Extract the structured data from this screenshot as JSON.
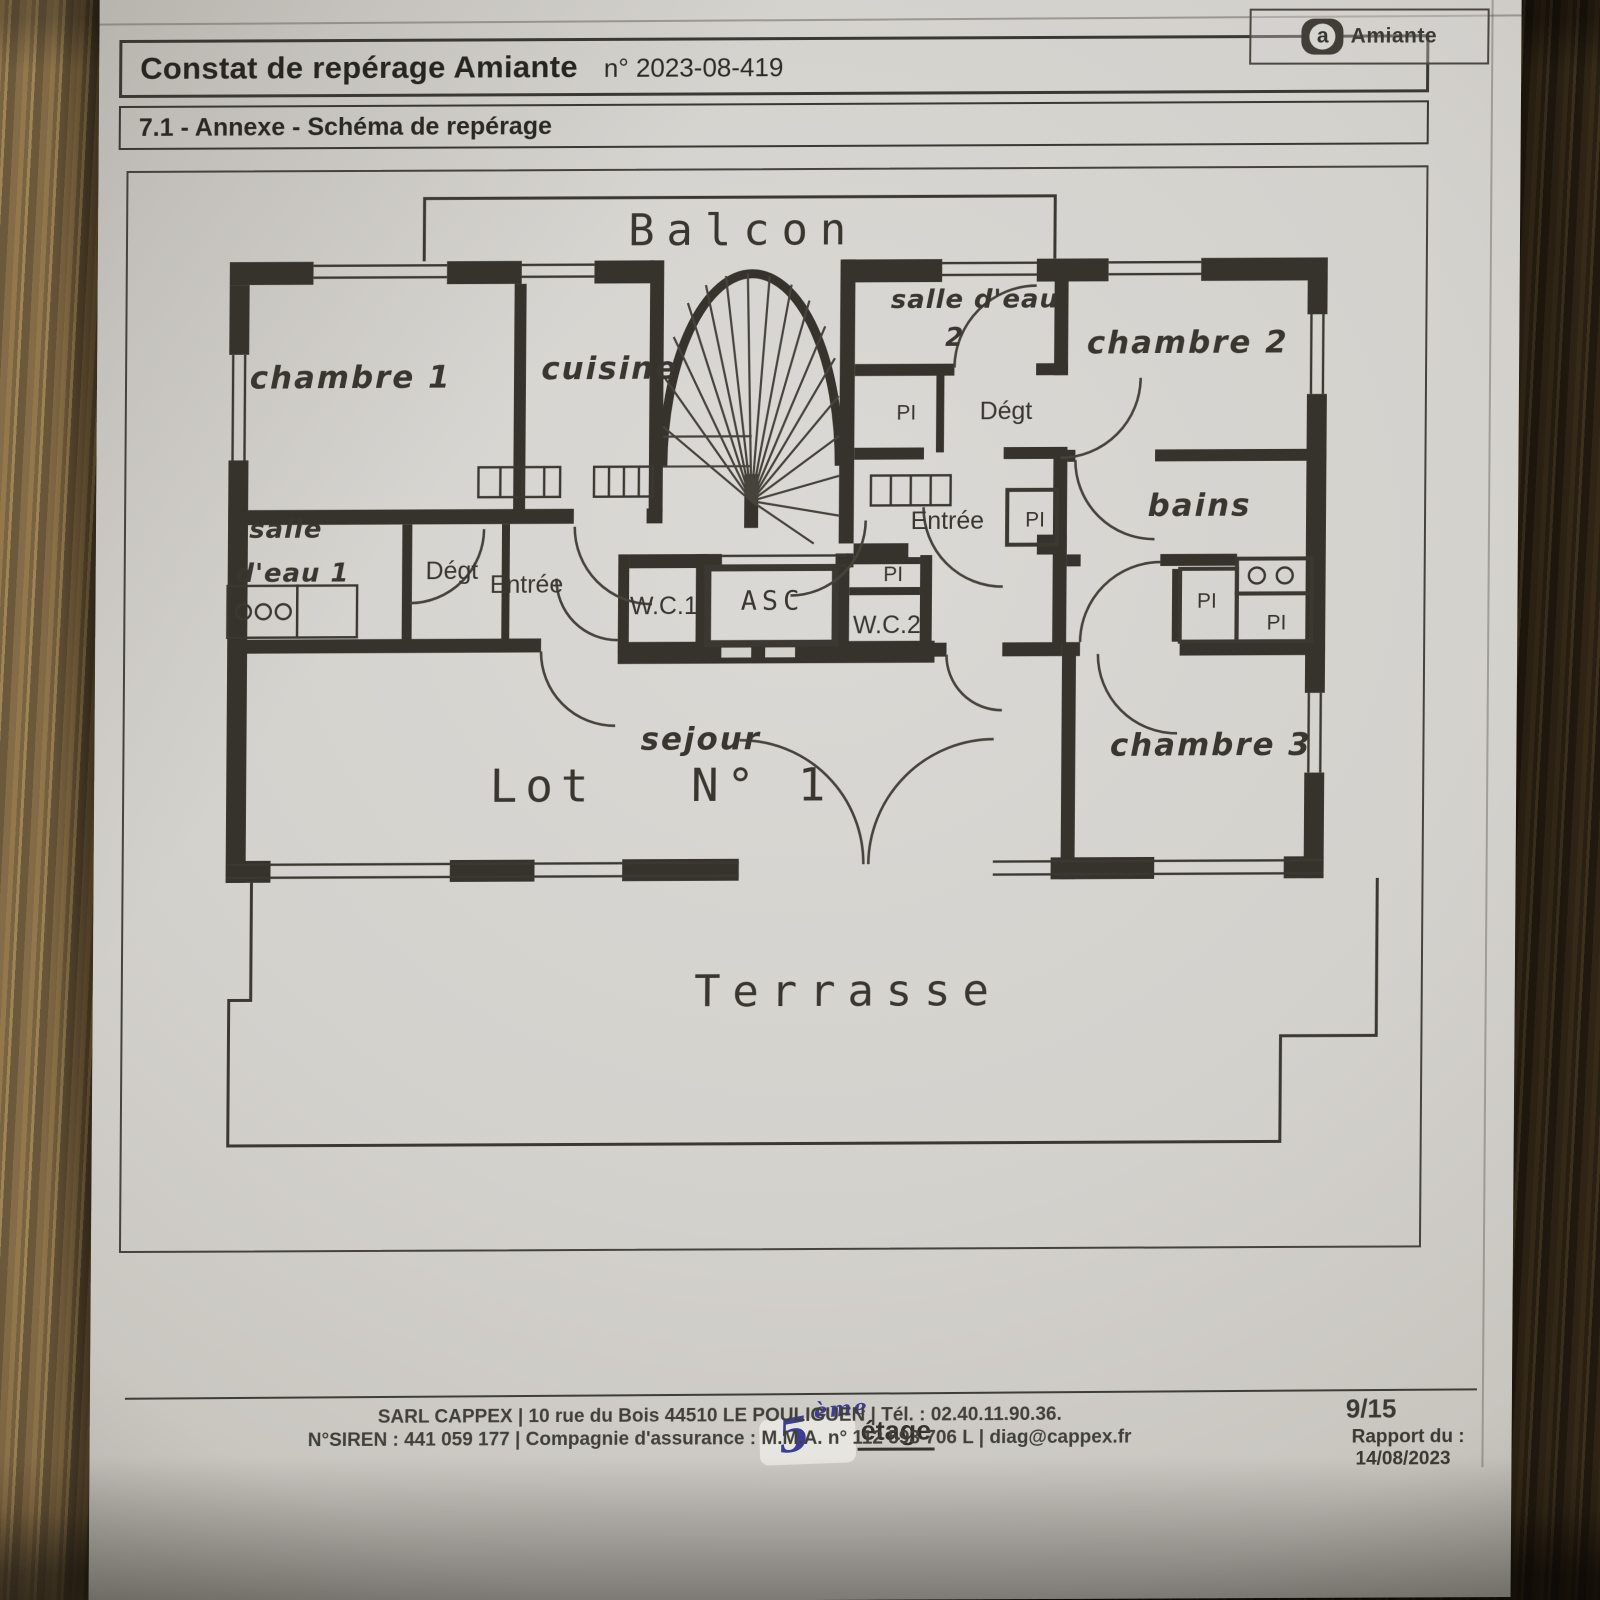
{
  "colors": {
    "handwriting_blue": "#3d3e93",
    "ink": "#38362f"
  },
  "header": {
    "title": "Constat de repérage Amiante",
    "report_number": "n° 2023-08-419",
    "logo_letter": "a",
    "logo_text": "Amiante"
  },
  "section_title": "7.1 - Annexe - Schéma de repérage",
  "plan": {
    "labels": {
      "balcon": "Balcon",
      "chambre1": "chambre 1",
      "cuisine": "cuisine",
      "salle_eau": "salle d'eau",
      "salle_eau_no": "2",
      "chambre2": "chambre 2",
      "pi": "PI",
      "degt": "Dégt",
      "entree": "Entrée",
      "bains": "bains",
      "salle": "salle",
      "d_eau_1": "d'eau 1",
      "wc1": "W.C.1",
      "asc": "ASC",
      "wc2": "W.C.2",
      "sejour": "sejour",
      "lot": "Lot",
      "lot_no": "N° 1",
      "chambre3": "chambre 3",
      "terrasse": "Terrasse"
    }
  },
  "floor_note": {
    "number": "5",
    "ordinal": "ème",
    "word": "étage"
  },
  "footer": {
    "line1": "SARL CAPPEX | 10 rue du Bois 44510 LE POULIGUEN | Tél. : 02.40.11.90.36.",
    "line2": "N°SIREN : 441 059 177 | Compagnie d'assurance : M.M.A. n° 112 593 706 L | diag@cappex.fr",
    "page": "9/15",
    "report_label": "Rapport du :",
    "report_date": "14/08/2023"
  }
}
